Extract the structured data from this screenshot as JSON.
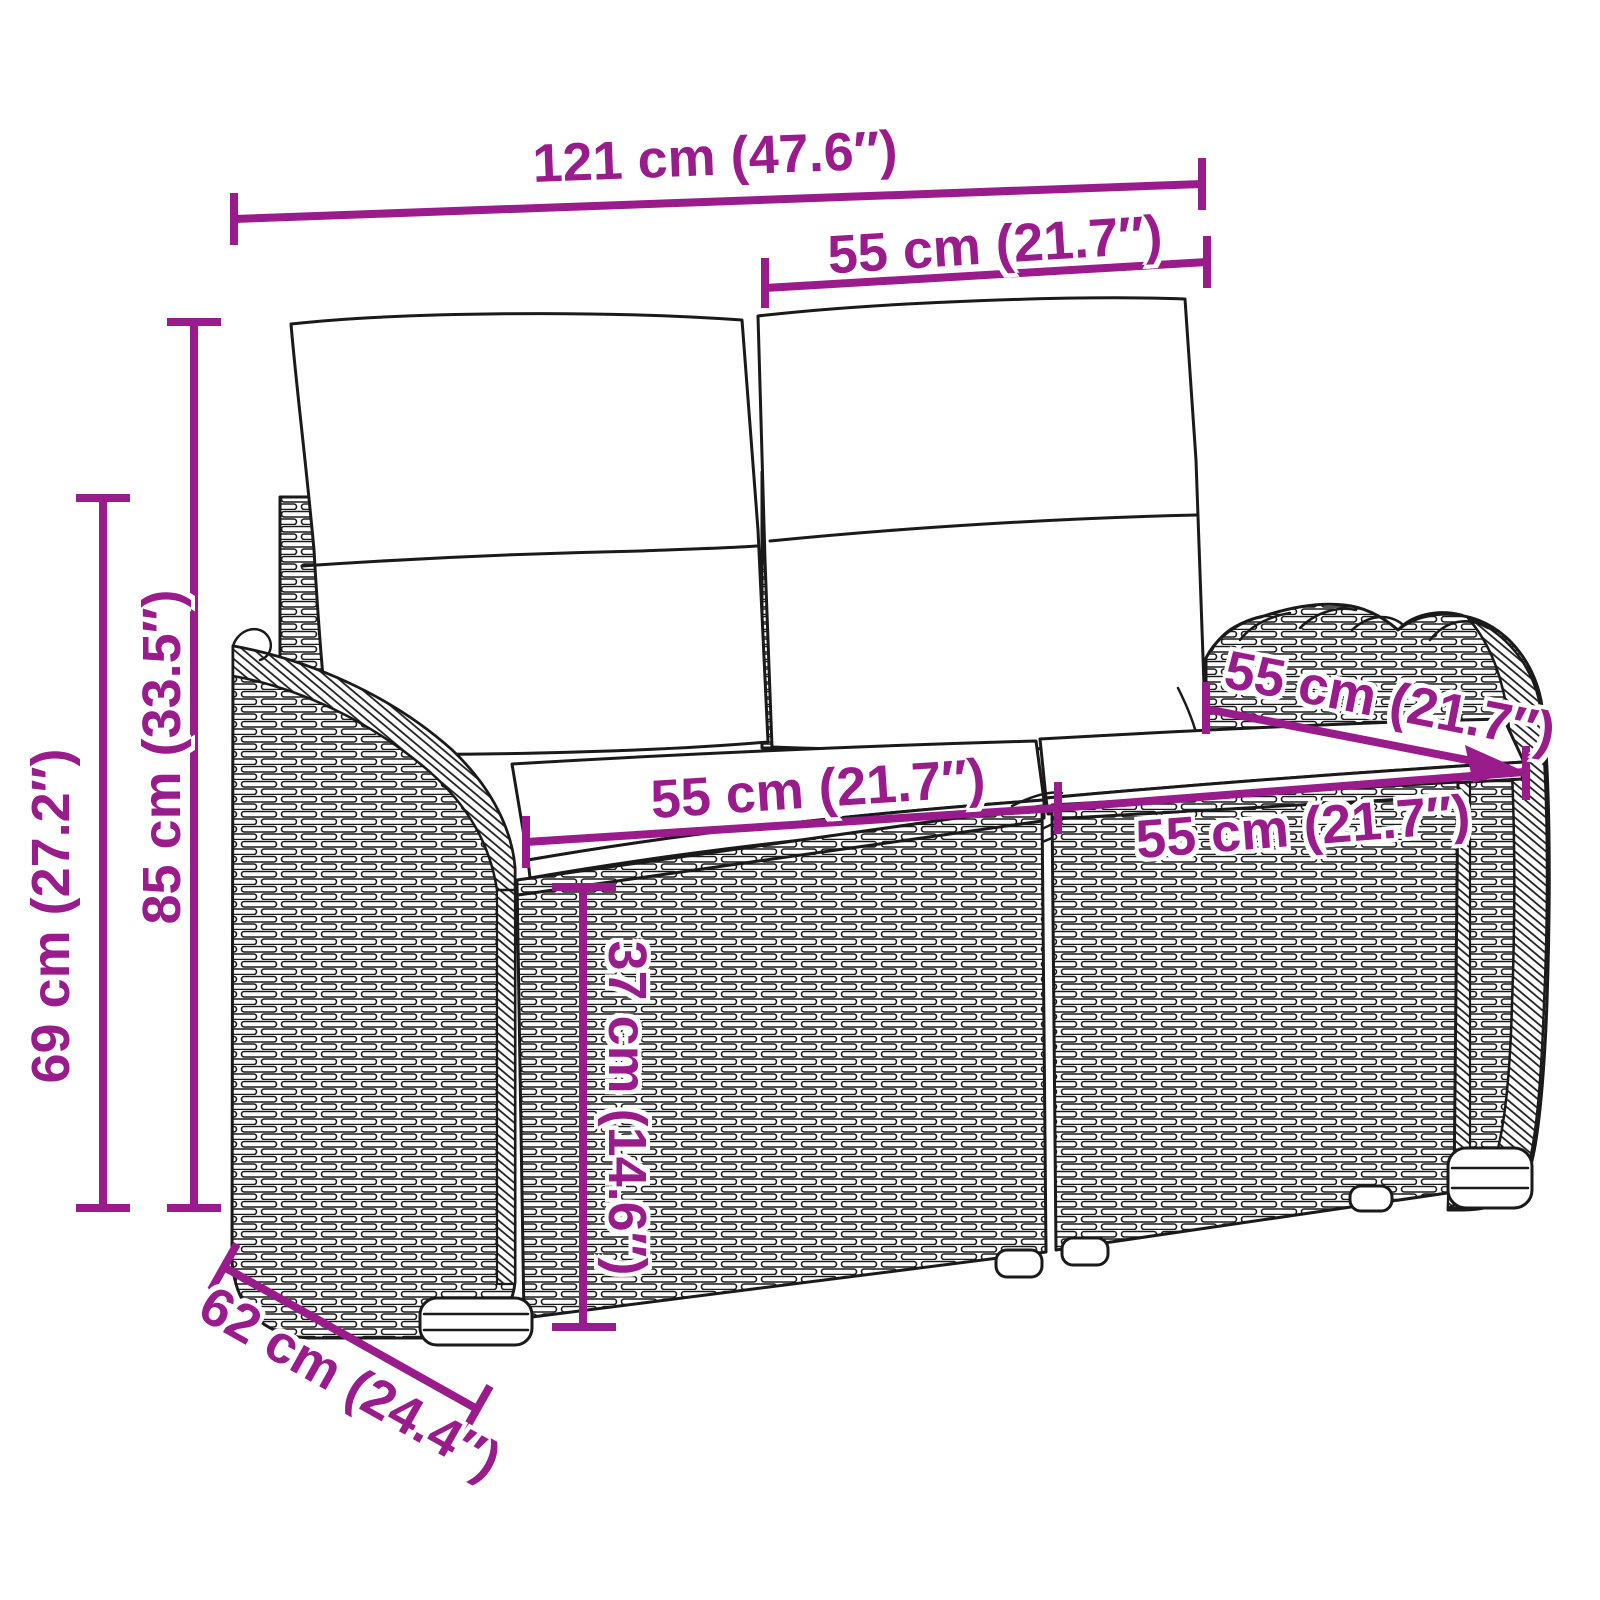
{
  "page": {
    "title": "Garden bench dimension diagram"
  },
  "product": {
    "name": "Poly rattan 2-seater garden bench with cushions"
  },
  "colors": {
    "dimension": "#9a1b8c",
    "outline": "#1a1a1a",
    "background": "#ffffff"
  },
  "dimensions": {
    "overall_width": {
      "cm": 121,
      "inch": 47.6,
      "label": "121 cm (47.6″)"
    },
    "back_cushion_width": {
      "cm": 55,
      "inch": 21.7,
      "label": "55 cm (21.7″)"
    },
    "total_height": {
      "cm": 85,
      "inch": 33.5,
      "label": "85 cm (33.5″)"
    },
    "armrest_height": {
      "cm": 69,
      "inch": 27.2,
      "label": "69 cm (27.2″)"
    },
    "seat_width_left": {
      "cm": 55,
      "inch": 21.7,
      "label": "55 cm (21.7″)"
    },
    "seat_width_right": {
      "cm": 55,
      "inch": 21.7,
      "label": "55 cm (21.7″)"
    },
    "seat_depth": {
      "cm": 55,
      "inch": 21.7,
      "label": "55 cm (21.7″)"
    },
    "seat_height": {
      "cm": 37,
      "inch": 14.6,
      "label": "37 cm (14.6″)"
    },
    "overall_depth": {
      "cm": 62,
      "inch": 24.4,
      "label": "62 cm (24.4″)"
    }
  }
}
